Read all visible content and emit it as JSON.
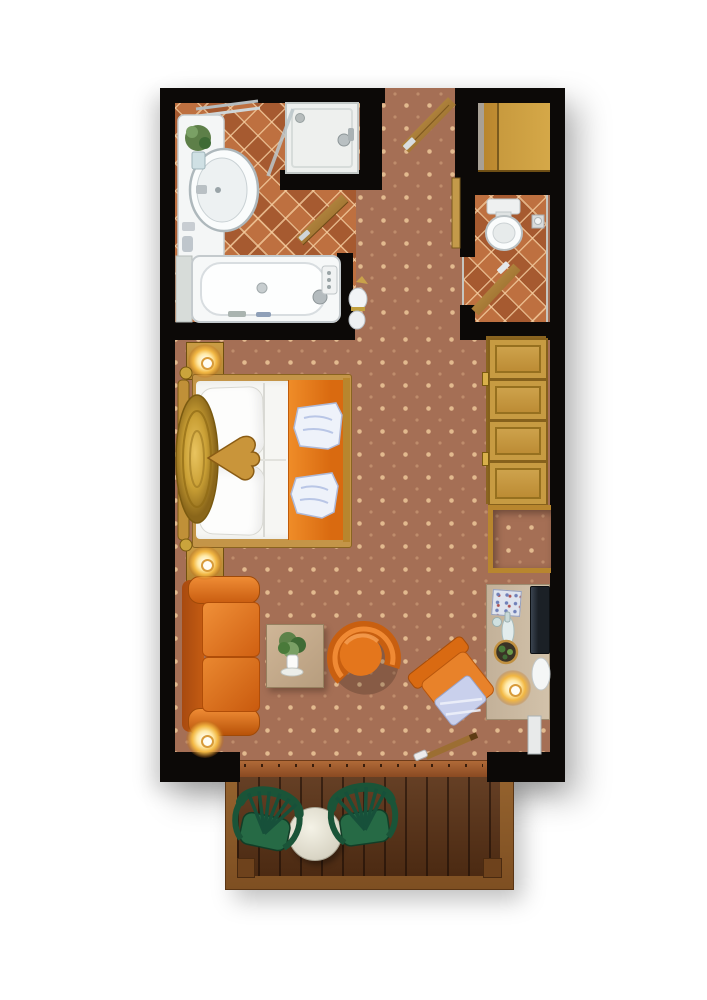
{
  "meta": {
    "type": "floor-plan",
    "title": "Hotel studio room floor plan (top-down render)",
    "visible_text": []
  },
  "palette": {
    "wall": "#0c0907",
    "carpet": "#a56f55",
    "carpet_dot": "#ecc698",
    "bathroom_tile": "#b4683a",
    "wood_furniture": "#c49a4a",
    "accent_orange": "#e0701c",
    "sofa_orange": "#d96a15",
    "fixture_white": "#f6f8f8",
    "garden_chair_green": "#206044",
    "deck_wood": "#5c3316",
    "lamp_glow": "#ffe9a6"
  },
  "rooms": [
    {
      "id": "bathroom",
      "name": "Bathroom",
      "floor": "terracotta tile",
      "furniture": [
        "vanity with washbasin",
        "plant",
        "shower cabin",
        "bathtub",
        "side shelf",
        "wooden door"
      ]
    },
    {
      "id": "hallway",
      "name": "Entry hallway",
      "floor": "dotted carpet",
      "furniture": [
        "entry door",
        "decorative vase",
        "door trim"
      ]
    },
    {
      "id": "wc",
      "name": "WC room",
      "floor": "terracotta tile",
      "furniture": [
        "toilet",
        "paper holder",
        "wooden door"
      ]
    },
    {
      "id": "entry_closet",
      "name": "Entry closet niche",
      "floor": "-",
      "furniture": [
        "wooden wardrobe"
      ]
    },
    {
      "id": "main_room",
      "name": "Bedroom / living room",
      "floor": "dotted carpet",
      "furniture": [
        "double bed with orange runner and two towels",
        "carved headboard",
        "2 nightstands with lit lamps",
        "4-door wardrobe",
        "luggage niche",
        "desk with TV, bottle, bowl and lit lamp",
        "desk chair with patterned cushion",
        "orange sofa",
        "floor lamp",
        "coffee table with plant",
        "orange tub armchair"
      ]
    },
    {
      "id": "balcony",
      "name": "Balcony",
      "floor": "wooden deck",
      "furniture": [
        "2 green garden chairs",
        "round white table"
      ]
    }
  ],
  "counts": {
    "balcony_chairs": 2,
    "nightstands": 2,
    "wardrobe_doors": 4,
    "bed_towels": 2,
    "lit_lamps": 4
  },
  "labels": {
    "floor_plan": "Hotel studio room floor plan",
    "bathroom": "Bathroom",
    "hallway": "Entry hallway",
    "wc_room": "WC room",
    "main_room": "Bedroom / living room",
    "balcony": "Balcony",
    "vanity": "Vanity with washbasin",
    "washbasin": "Washbasin",
    "vanity_plant": "Plant on vanity",
    "shower": "Shower cabin",
    "bathtub": "Bathtub",
    "bath_shelf": "Side shelf",
    "bathroom_door": "Bathroom door",
    "entry_door": "Entry door",
    "entry_wardrobe": "Entry closet",
    "door_trim": "Door trim",
    "hall_vase": "Decorative vase",
    "toilet": "Toilet",
    "tp_holder": "Toilet paper holder",
    "wc_door": "WC door",
    "bed": "Double bed",
    "headboard": "Carved headboard",
    "pillow": "Pillow",
    "bed_runner": "Orange bed runner",
    "towel": "Folded towel",
    "heart_decor": "Wooden heart decoration",
    "nightstand": "Nightstand with lamp",
    "wardrobe": "Wardrobe (4 doors)",
    "luggage_niche": "Luggage niche",
    "desk": "Desk",
    "tv": "TV",
    "desk_items": "Bottle, glass and bowl",
    "magazine": "Magazine",
    "desk_lamp": "Desk lamp",
    "desk_chair": "Desk chair",
    "sofa": "Sofa",
    "floor_lamp": "Floor lamp",
    "coffee_table": "Coffee table",
    "table_plant": "Plant in vase",
    "armchair": "Tub armchair",
    "balcony_rod": "Sliding door handle",
    "threshold": "Balcony door threshold",
    "deck": "Wooden deck",
    "balcony_table": "Round balcony table",
    "balcony_chair_1": "Garden chair",
    "balcony_chair_2": "Garden chair"
  }
}
